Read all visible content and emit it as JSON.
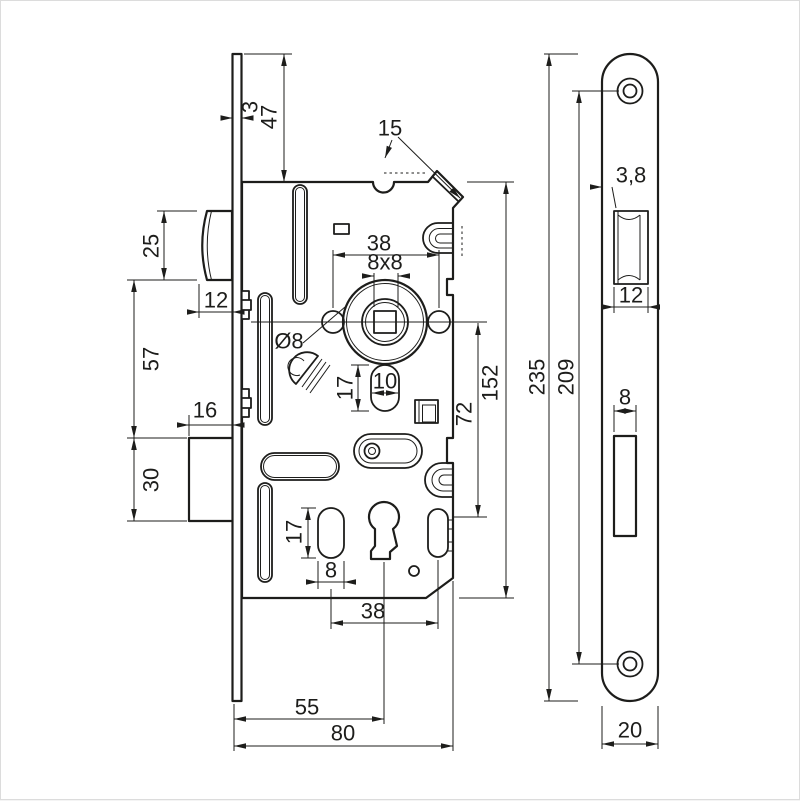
{
  "drawing": {
    "type": "technical-drawing",
    "subject": "mortise-door-lock",
    "views": {
      "left": "lock case side view",
      "right": "faceplate front view"
    }
  },
  "colors": {
    "line": "#1d1d1b",
    "background": "#ffffff"
  },
  "dims": {
    "plate_thickness": "3",
    "plate_top_to_case": "47",
    "latch_height": "25",
    "latch_protrusion": "12",
    "latch_to_deadbolt": "57",
    "deadbolt_protrusion": "16",
    "deadbolt_height": "30",
    "follower_pin_span": "38",
    "spindle_square": "8x8",
    "pin_diameter": "Ø8",
    "hub_slot_width": "10",
    "hub_slot_height": "17",
    "corner_tab": "15",
    "follower_to_key": "72",
    "case_height": "152",
    "key_slot_height": "17",
    "key_slot_width": "8",
    "key_span": "38",
    "backset": "55",
    "case_depth": "80",
    "faceplate_length": "235",
    "screw_spacing": "209",
    "latch_cut_offset": "3,8",
    "latch_cut_width": "12",
    "bolt_cut_width": "8",
    "faceplate_width": "20"
  }
}
